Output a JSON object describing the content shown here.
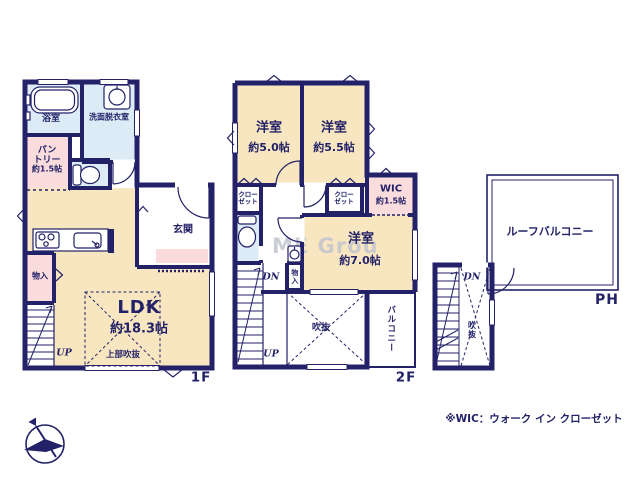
{
  "colors": {
    "wall": "#232268",
    "room_beige": "#f7e6c0",
    "room_pink": "#f9dcdb",
    "room_blue": "#dcebf6",
    "watermark_gray": "#c3c5ce"
  },
  "floor1": {
    "label": "1F",
    "bath": "浴室",
    "washroom": "洗面脱衣室",
    "pantry_line1": "パン",
    "pantry_line2": "トリー",
    "pantry_size": "約1.5帖",
    "entrance": "玄関",
    "storage": "物入",
    "ldk": "LDK",
    "ldk_size": "約18.3帖",
    "open_ceiling": "上部吹抜",
    "up": "UP"
  },
  "floor2": {
    "label": "2F",
    "room_a": "洋室",
    "room_a_size": "約5.0帖",
    "room_b": "洋室",
    "room_b_size": "約5.5帖",
    "room_c": "洋室",
    "room_c_size": "約7.0帖",
    "closet_line1": "クロー",
    "closet_line2": "ゼット",
    "wic": "WIC",
    "wic_size": "約1.5帖",
    "storage": "物入",
    "void": "吹抜",
    "balcony": "バルコニー",
    "dn": "DN",
    "up": "UP"
  },
  "penthouse": {
    "label": "PH",
    "roof_balcony": "ルーフバルコニー",
    "void": "吹抜",
    "dn": "DN"
  },
  "notes": {
    "footnote": "※WIC：ウォーク イン クローゼット",
    "watermark": "ME Grou"
  }
}
